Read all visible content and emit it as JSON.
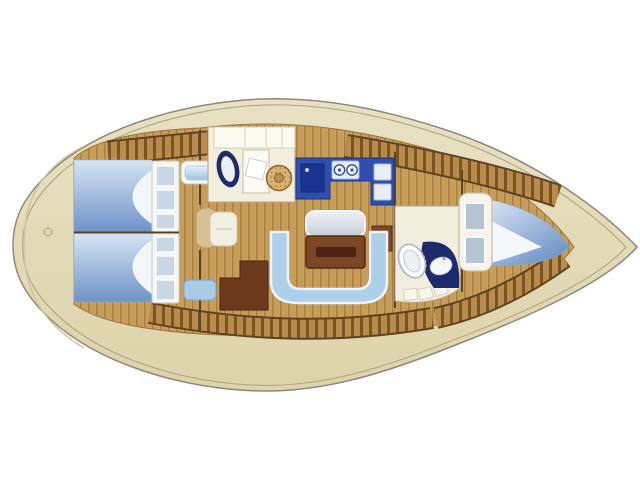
{
  "diagram": {
    "name": "sailing-yacht-interior-layout-plan",
    "view": "overhead",
    "bow_direction": "right",
    "stern_direction": "left",
    "background": "#ffffff"
  },
  "colors": {
    "hull_cream": "#e8e1c3",
    "hull_cream_dark": "#ddd3ab",
    "hull_outline": "#8f8876",
    "deck_line": "#b2a884",
    "floor_wood": "#c79d5a",
    "plank_line": "#a87e41",
    "locker_light": "#b78c4c",
    "locker_dark": "#7c5424",
    "locker_edge": "#5e4320",
    "bulkhead": "#574628",
    "berth_light": "#d7e4f3",
    "berth_deep": "#6e93c7",
    "linen_white": "#f3f7fb",
    "settee_blue": "#aecfe9",
    "settee_trim": "#edf4fa",
    "seat_blue": "#a9cbe8",
    "table_wood": "#7c4628",
    "table_slot": "#4e2310",
    "desk_wood": "#6d391d",
    "galley_blue": "#2d4fae",
    "galley_sink": "#1b3492",
    "appliance_white": "#e9edf5",
    "room_cream": "#f2eddc",
    "cabinet_white": "#fbfaf1",
    "fixture_navy": "#1d2a6b",
    "porcelain": "#edeff2",
    "basin_tan": "#d9b272",
    "step_tan": "#d7c092",
    "step_white": "#f1efe2",
    "wardrobe_white": "#f5f3eb",
    "window_gray": "#b6c3d3"
  },
  "compartments": [
    {
      "id": "stern-deck",
      "label": "stern deck"
    },
    {
      "id": "aft-cabin-upper",
      "label": "aft double cabin",
      "furniture": [
        "double-berth",
        "shelf-unit"
      ]
    },
    {
      "id": "aft-cabin-lower",
      "label": "aft double cabin",
      "furniture": [
        "double-berth",
        "shelf-unit"
      ]
    },
    {
      "id": "aft-head",
      "label": "head with shower",
      "furniture": [
        "toilet",
        "shower",
        "round-washbasin"
      ]
    },
    {
      "id": "galley",
      "label": "galley",
      "furniture": [
        "sink",
        "two-burner-stove",
        "worktop"
      ]
    },
    {
      "id": "saloon",
      "label": "saloon",
      "furniture": [
        "u-shaped-settee",
        "folding-table",
        "sideboard"
      ]
    },
    {
      "id": "nav-station",
      "label": "navigation station",
      "furniture": [
        "chart-desk",
        "seat",
        "companionway-steps"
      ]
    },
    {
      "id": "forward-head",
      "label": "forward head",
      "furniture": [
        "toilet",
        "vanity-washbasin"
      ]
    },
    {
      "id": "forward-cabin",
      "label": "V-berth cabin",
      "furniture": [
        "v-berth",
        "headboard-lockers",
        "shelf-fronts"
      ]
    }
  ]
}
